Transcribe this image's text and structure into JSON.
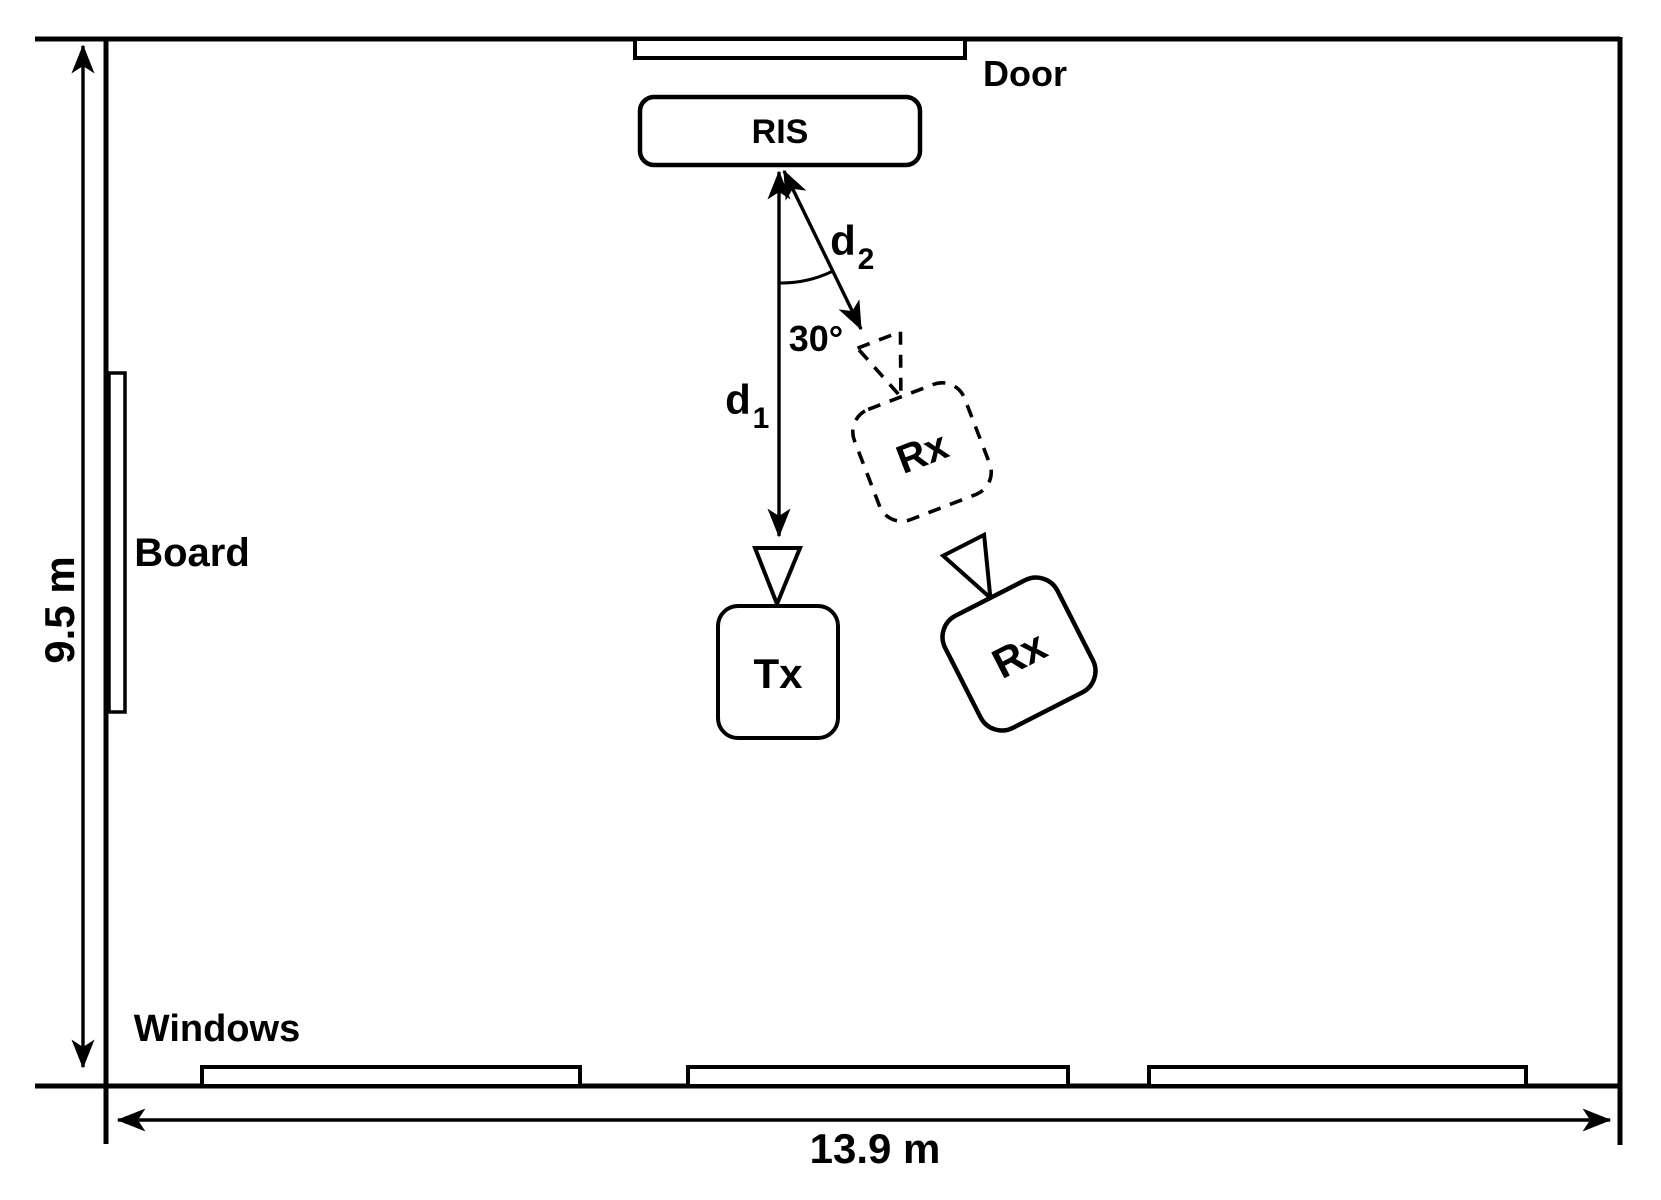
{
  "figure": {
    "background": "#ffffff",
    "line_color": "#000000"
  },
  "room": {
    "width_label": "13.9 m",
    "height_label": "9.5 m",
    "door_label": "Door",
    "board_label": "Board",
    "windows_label": "Windows"
  },
  "devices": {
    "ris_label": "RIS",
    "tx_label": "Tx",
    "rx_dashed_label": "Rx",
    "rx_solid_label": "Rx"
  },
  "annotations": {
    "distance1_base": "d",
    "distance1_sub": "1",
    "distance2_base": "d",
    "distance2_sub": "2",
    "angle_label": "30°"
  }
}
